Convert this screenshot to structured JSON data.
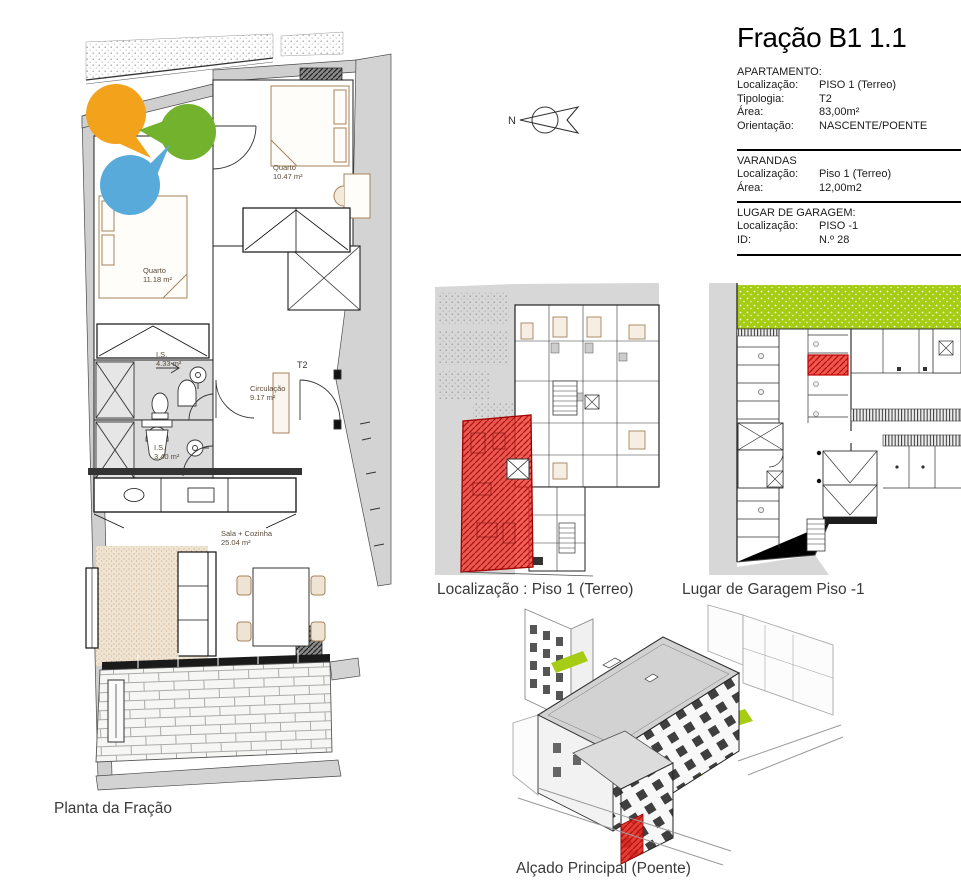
{
  "title": "Fração B1 1.1",
  "info_sections": [
    {
      "header": "APARTAMENTO:",
      "rows": [
        {
          "label": "Localização:",
          "value": "PISO 1 (Terreo)"
        },
        {
          "label": "Tipologia:",
          "value": "T2"
        },
        {
          "label": "Área:",
          "value": "83,00m²"
        },
        {
          "label": "Orientação:",
          "value": "NASCENTE/POENTE"
        }
      ]
    },
    {
      "header": "VARANDAS",
      "rows": [
        {
          "label": "Localização:",
          "value": "Piso 1 (Terreo)"
        },
        {
          "label": "Área:",
          "value": "12,00m2"
        }
      ]
    },
    {
      "header": "LUGAR DE GARAGEM:",
      "rows": [
        {
          "label": "Localização:",
          "value": "PISO -1"
        },
        {
          "label": "ID:",
          "value": "N.º 28"
        }
      ]
    }
  ],
  "compass": {
    "label": "N"
  },
  "floorplan": {
    "caption": "Planta da Fração",
    "entry_label": "T2",
    "rooms": [
      {
        "name": "Quarto",
        "area": "10.47 m²"
      },
      {
        "name": "Quarto",
        "area": "11.18 m²"
      },
      {
        "name": "I.S.",
        "area": "4.33 m²"
      },
      {
        "name": "I.S.",
        "area": "3.40 m²"
      },
      {
        "name": "Circulação",
        "area": "9.17 m²"
      },
      {
        "name": "Sala + Cozinha",
        "area": "25.04 m²"
      }
    ],
    "markers": [
      {
        "name": "orange-marker",
        "color": "#F2A21B"
      },
      {
        "name": "green-marker",
        "color": "#73B22C"
      },
      {
        "name": "blue-marker",
        "color": "#58AADB"
      }
    ]
  },
  "location_plan": {
    "caption": "Localização : Piso 1 (Terreo)",
    "highlight_color": "#EE3A30"
  },
  "garage_plan": {
    "caption": "Lugar de Garagem Piso -1",
    "highlight_color": "#EE3A30",
    "grass_color": "#A6CC14"
  },
  "elevation": {
    "caption": "Alçado Principal (Poente)",
    "highlight_color": "#E42A20"
  }
}
